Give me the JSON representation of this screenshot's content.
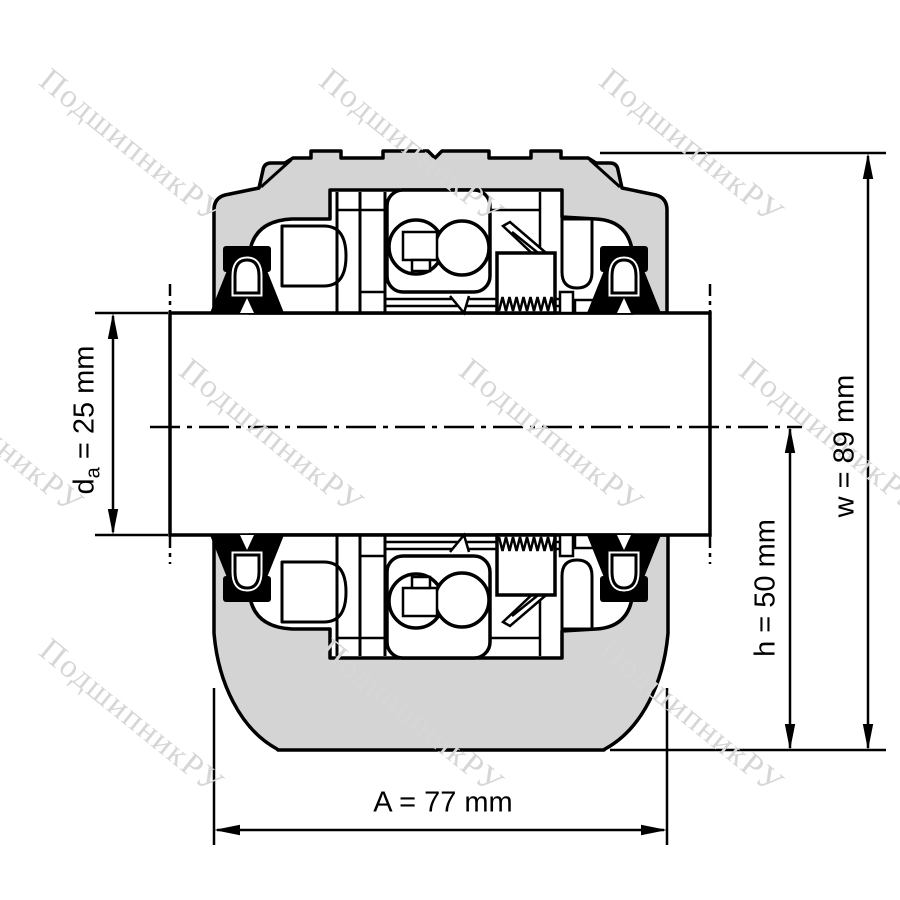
{
  "watermark": {
    "text": "ПодшипникРУ",
    "color": "#d6d6d6"
  },
  "dimensions": {
    "bore_diameter": {
      "symbol_base": "d",
      "symbol_sub": "a",
      "value_text": " = 25 mm"
    },
    "center_height": {
      "text": "h = 50 mm"
    },
    "total_height": {
      "text": "w = 89 mm"
    },
    "total_width": {
      "text": "A = 77 mm"
    }
  },
  "colors": {
    "housing_fill": "#d4d4d4",
    "line": "#000000",
    "background": "#ffffff"
  }
}
